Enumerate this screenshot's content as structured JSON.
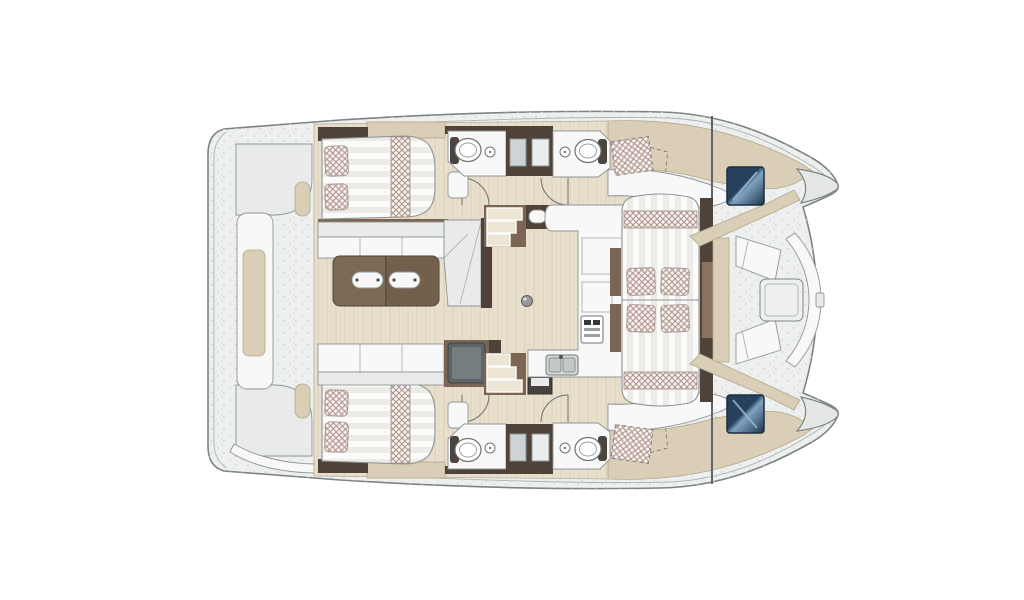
{
  "figure": {
    "type": "floor-plan",
    "label": "Catamaran yacht interior layout, top view floor plan"
  },
  "inventory": {
    "double-beds": 4,
    "pillows": 8,
    "toilets": 4,
    "washbasins": 4,
    "galley-sinks": 1,
    "stoves": 1,
    "salon-tables": 1,
    "cockpit-tables": 1,
    "sofas": 2,
    "corner-seats": 1,
    "staircases": 2,
    "door-swings": 4,
    "blue-windows": 2,
    "bow-tips": 2,
    "dashed-lockers": 2,
    "shower-cabinets": 2
  },
  "colors": {
    "page-bg": "#ffffff",
    "deck": "#eef0ef",
    "deck-speckle": "#d5dad8",
    "outline": "#7d8284",
    "line-light": "#aeb3b3",
    "stroke": "#8f9597",
    "wood-floor": "#e8e0cd",
    "wood-grain": "#d8ccb2",
    "furn-white": "#f7f8f7",
    "furn-shadow": "#e9ebea",
    "mattress": "#fbfbfa",
    "mattress-stripe": "#ebebe7",
    "fabric-base": "#f7f3f0",
    "fabric-line": "#b1948e",
    "wall-brown": "#4f4238",
    "mid-brown": "#7c6653",
    "door-brown": "#8a7360",
    "table-brown": "#7d6a55",
    "table-brown-dark": "#73604c",
    "trim-beige": "#dacfb6",
    "trim-beige-line": "#b3a78c",
    "module-gray": "#5d6366",
    "module-gray-light": "#767d7e",
    "shelf-dark": "#46423d",
    "step-beige": "#ece5d4",
    "sink-gray": "#d7dbda",
    "window-blue-1": "#27415c",
    "window-blue-2": "#7fa3c2",
    "window-blue-3": "#1d3349",
    "window-frame": "#1c2e40"
  }
}
